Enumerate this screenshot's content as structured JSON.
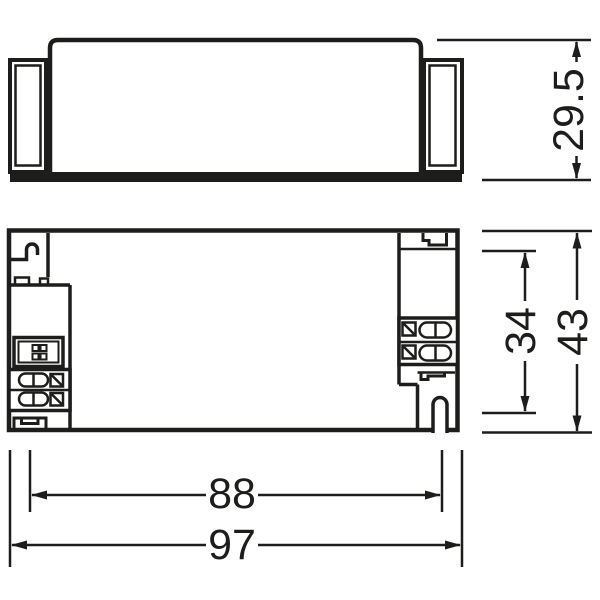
{
  "drawing": {
    "description": "technical-dimension-drawing-two-views",
    "colors": {
      "line": "#1d1d1b",
      "background": "#ffffff"
    },
    "dimensions": {
      "device_height": "29.5",
      "mounting_spacing_width": "34",
      "device_width": "43",
      "mounting_spacing_length": "88",
      "device_length": "97"
    }
  }
}
